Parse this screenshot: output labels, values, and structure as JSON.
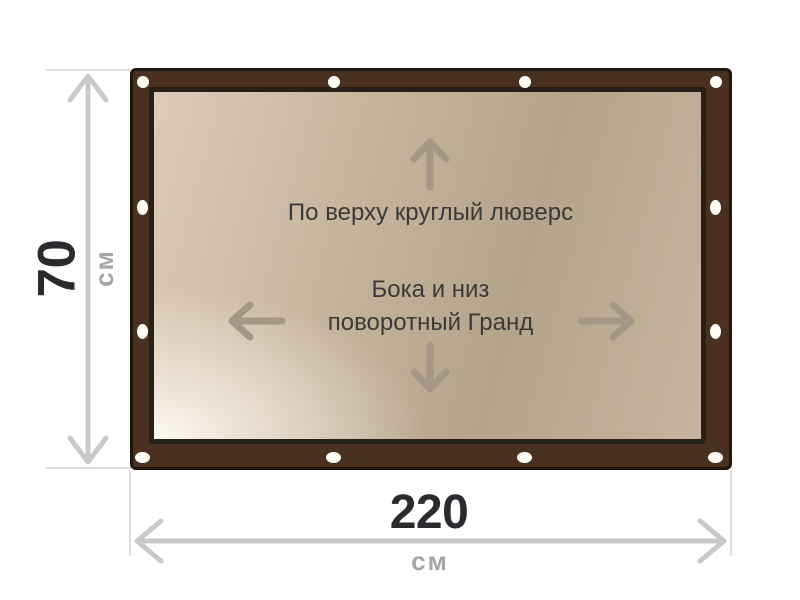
{
  "diagram": {
    "type": "product-dimension-diagram",
    "top_annotation": "По верху круглый люверс",
    "center_annotation_line1": "Бока и низ",
    "center_annotation_line2": "поворотный Гранд",
    "grommet_count": 12
  },
  "dimensions": {
    "height_value": "70",
    "height_unit": "см",
    "width_value": "220",
    "width_unit": "см"
  },
  "icons": {
    "arrow_up": "arrow-up-icon",
    "arrow_down": "arrow-down-icon",
    "arrow_left": "arrow-left-icon",
    "arrow_right": "arrow-right-icon",
    "height_measure": "vertical-double-arrow-icon",
    "width_measure": "horizontal-double-arrow-icon",
    "grommet": "grommet-hole-icon"
  },
  "colors": {
    "frame_brown": "#4a311f",
    "frame_outline": "#20170e",
    "banner_border": "#262019",
    "banner_light": "#f8f2ea",
    "banner_tan_mid": "#b5a48c",
    "banner_tan_top": "#dccbb7",
    "interior_arrow": "#a49786",
    "annotation_text": "#3b3a38",
    "dimension_value_text": "#292b2e",
    "dimension_unit_text": "#a6a6a6",
    "dimension_line": "#c9c9c9",
    "tick_line": "#dedede",
    "grommet_white": "#fffdf6"
  }
}
